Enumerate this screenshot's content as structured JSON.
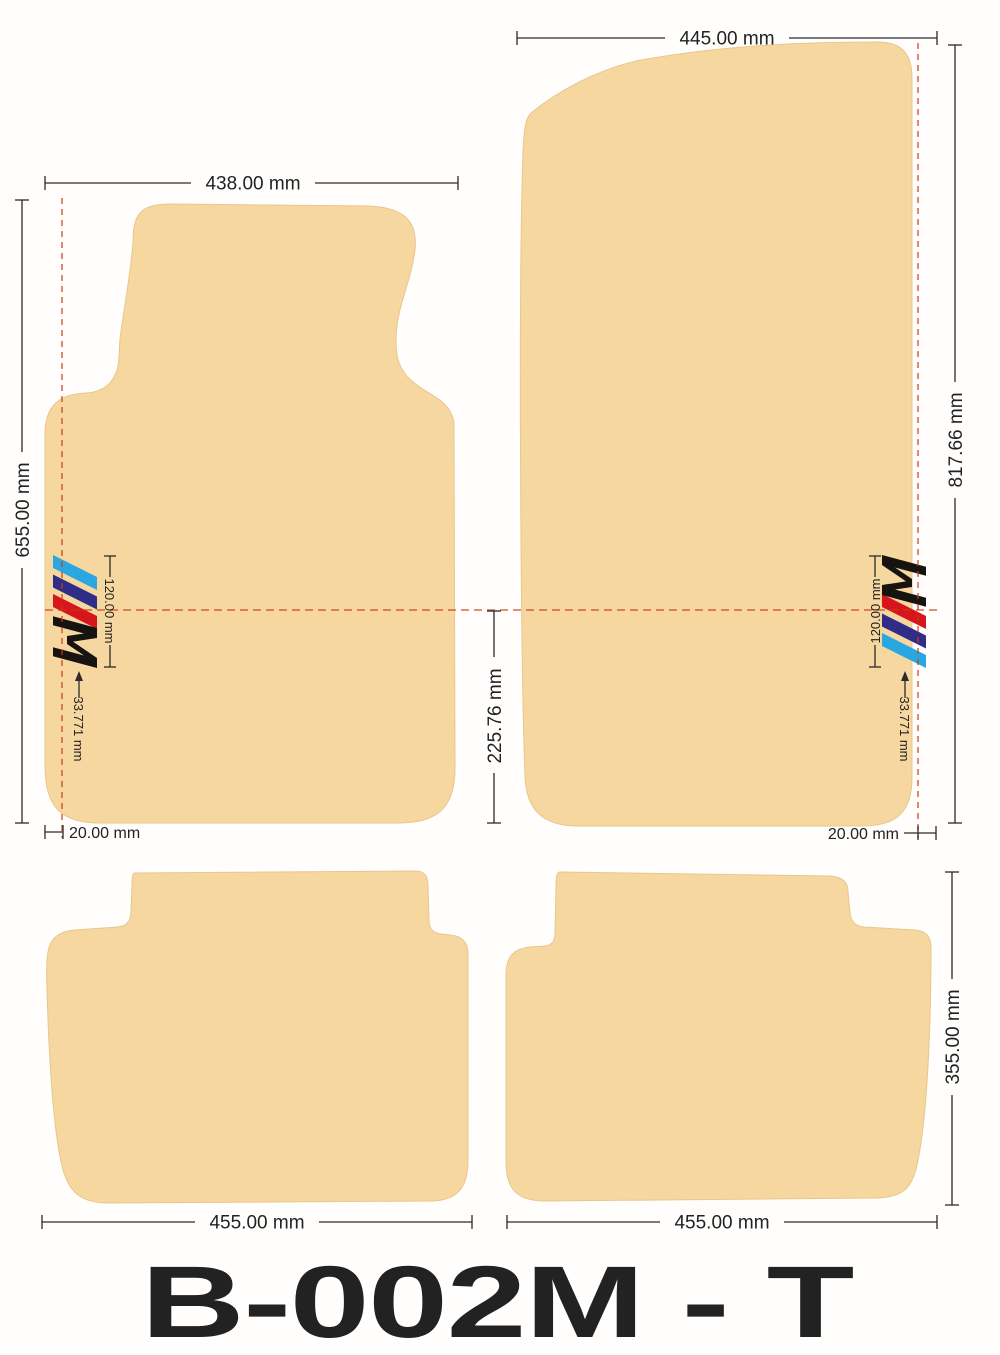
{
  "title": {
    "model_code": "B-002M - T"
  },
  "units": "mm",
  "dimensions": {
    "front_left": {
      "width": "438.00 mm",
      "height": "655.00 mm",
      "edge_offset": "20.00 mm",
      "logo_height": "120.00 mm",
      "logo_offset": "33.771 mm"
    },
    "front_right": {
      "width": "445.00 mm",
      "height": "817.66 mm",
      "edge_offset": "20.00 mm",
      "logo_height": "120.00 mm",
      "logo_offset": "33.771 mm"
    },
    "center_gap": {
      "height": "225.76 mm"
    },
    "rear_left": {
      "width": "455.00 mm"
    },
    "rear_right": {
      "width": "455.00 mm",
      "height": "355.00 mm"
    }
  },
  "colors": {
    "mat": "#f6d7a0",
    "mat_edge": "#e8c78c",
    "guide_line": "#cc3911",
    "dimension_line": "#2b2b2b",
    "stripe_blue": "#2aa7e0",
    "stripe_navy": "#2f2d87",
    "stripe_red": "#d6161c",
    "m_letter": "#161310",
    "title_text": "#241d16"
  },
  "logo": {
    "name": "m-stripes-logo",
    "letter": "M"
  }
}
